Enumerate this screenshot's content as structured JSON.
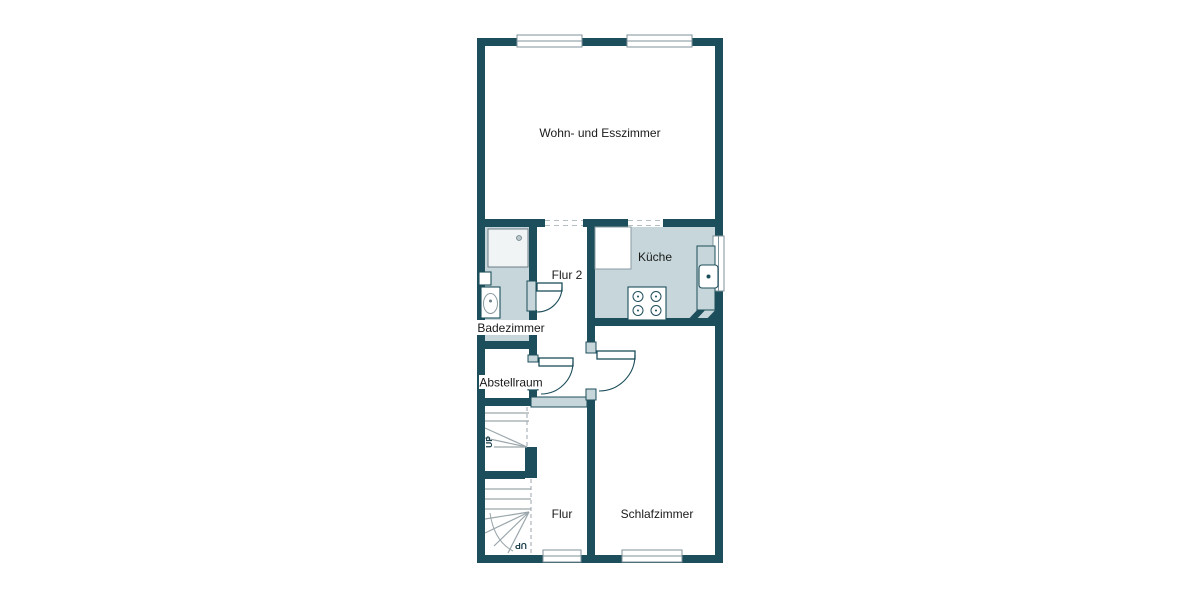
{
  "floorplan": {
    "rooms": [
      {
        "id": "wohn-esszimmer",
        "label": "Wohn- und Esszimmer"
      },
      {
        "id": "kueche",
        "label": "Küche"
      },
      {
        "id": "flur-2",
        "label": "Flur 2"
      },
      {
        "id": "badezimmer",
        "label": "Badezimmer"
      },
      {
        "id": "abstellraum",
        "label": "Abstellraum"
      },
      {
        "id": "flur",
        "label": "Flur"
      },
      {
        "id": "schlafzimmer",
        "label": "Schlafzimmer"
      }
    ],
    "stairs": {
      "upper_run_label": "UP",
      "lower_run_label": "UP"
    },
    "fixtures": [
      "shower-icon",
      "toilet-icon",
      "stove-icon",
      "kitchen-sink-icon",
      "kitchen-counter",
      "fridge-counter-block"
    ],
    "colors": {
      "wall": "#1d4e5b",
      "wet_room_fill": "#c6d6da",
      "stair_tread": "#9aa6ab",
      "window_frame": "#7d929b",
      "label_text": "#1a1a1a",
      "background": "#ffffff"
    }
  }
}
